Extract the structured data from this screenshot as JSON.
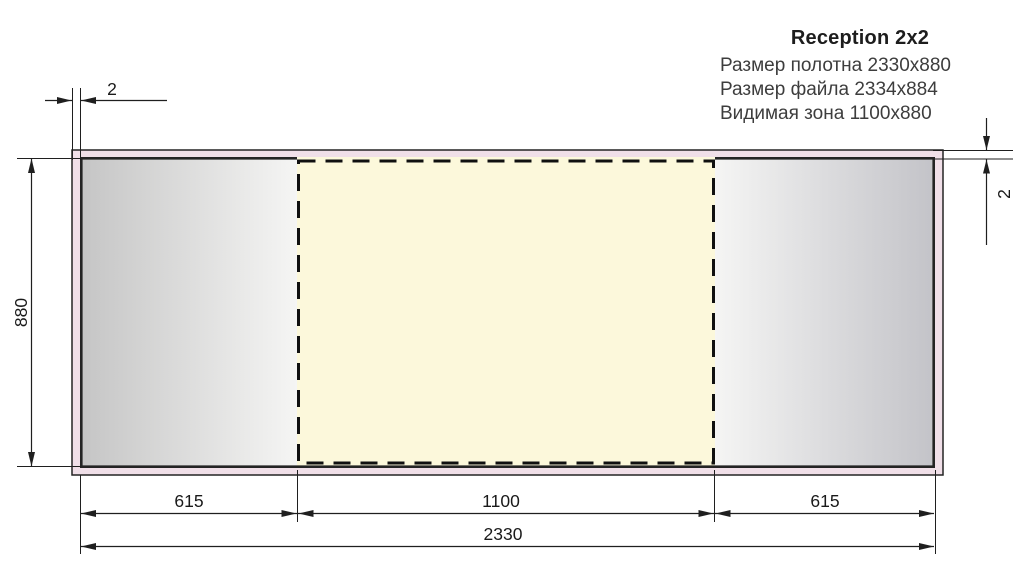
{
  "header": {
    "title": "Reception 2x2",
    "specs": [
      "Размер полотна 2330x880",
      "Размер файла 2334x884",
      "Видимая зона 1100x880"
    ]
  },
  "dimensions": {
    "bleed_left": "2",
    "bleed_top": "2",
    "canvas_height": "880",
    "left_panel_width": "615",
    "visible_zone_width": "1100",
    "right_panel_width": "615",
    "canvas_width": "2330"
  },
  "colors": {
    "file_margin_fill": "#f0dfe8",
    "visible_zone_fill": "#fcf8db",
    "panel_edge_gray": "#c5c5c5",
    "panel_center_light": "#f5f5f4",
    "panel_edge_gray_right": "#c3c3c8",
    "line_color": "#1f1f1f"
  }
}
